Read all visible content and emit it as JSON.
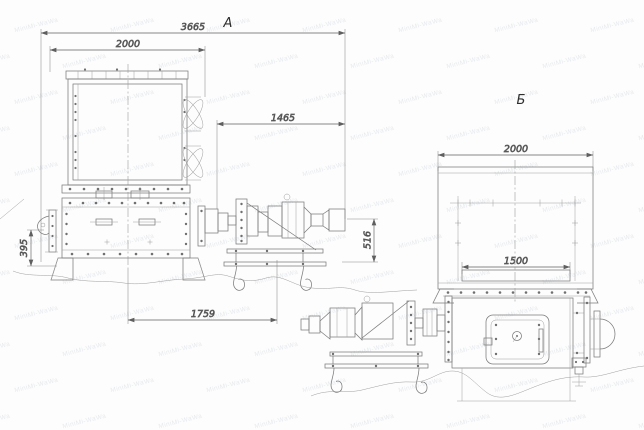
{
  "drawing": {
    "views": {
      "a_label": "А",
      "b_label": "Б"
    },
    "dimensions": {
      "a_overall_length": "3665",
      "a_body_width": "2000",
      "a_drive_length": "1465",
      "a_trough_height": "395",
      "a_base_length": "1759",
      "a_drive_height": "516",
      "b_body_width": "2000",
      "b_opening_width": "1500"
    },
    "watermark_text": "MiniMi-WaWa",
    "colors": {
      "line": "#7c7c7c",
      "dimension_text": "#3d3d3d",
      "background": "#ffffff"
    }
  }
}
